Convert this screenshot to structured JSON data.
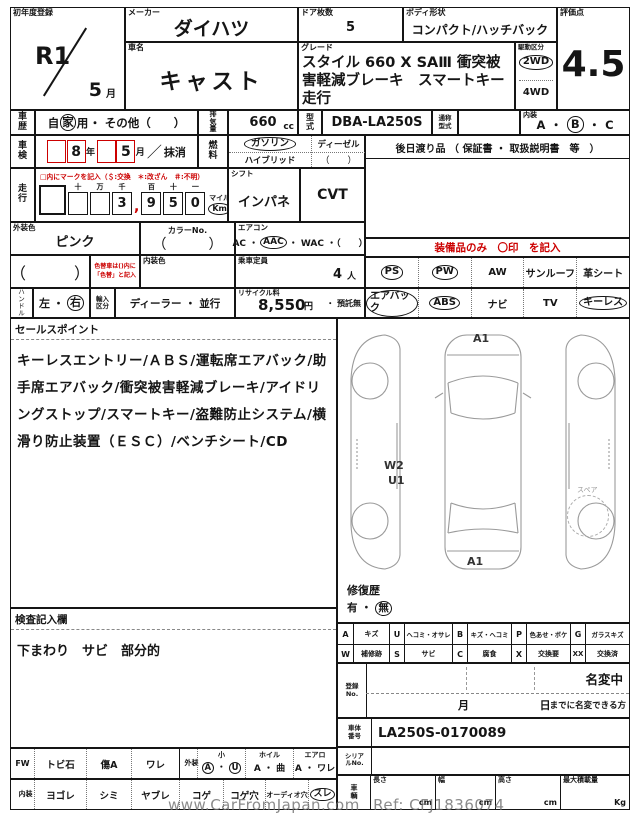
{
  "colors": {
    "line": "#151515",
    "red": "#cc0000",
    "watermark_gray": "#6e6e6e"
  },
  "watermark": {
    "site": "www.CarFromJapan.com",
    "ref": "Ref: CFJ1836074"
  },
  "header": {
    "first_reg_label": "初年度登録",
    "first_reg_year": "R1",
    "first_reg_month": "5",
    "month_suffix": "月",
    "maker_label": "メーカー",
    "maker": "ダイハツ",
    "car_name_label": "車名",
    "car_name": "キャスト",
    "doors_label": "ドア枚数",
    "doors": "5",
    "body_label": "ボディ形状",
    "body": "コンパクト/ハッチバック",
    "grade_label": "グレード",
    "grade": "スタイル 660 X SAⅢ 衝突被害軽減ブレーキ　スマートキー　走行",
    "drive_label": "駆動区分",
    "drive_2wd": "2WD",
    "drive_4wd": "4WD",
    "score_label": "評価点",
    "score": "4.5"
  },
  "history": {
    "label": "車歴",
    "use_pre": "自",
    "use_circled": "家",
    "use_post": "用",
    "use_other": "・ その他（　　）",
    "disp_label": "排気量",
    "disp_value": "660",
    "disp_unit": "cc",
    "model_label": "型式",
    "model_value": "DBA-LA250S",
    "alias_label": "通称型式",
    "interior_label": "内装",
    "interior_a": "A",
    "interior_b": "B",
    "interior_c": "C",
    "dot": "・"
  },
  "shaken": {
    "label": "車検",
    "year": "8",
    "year_suffix": "年",
    "month": "5",
    "month_suffix": "月",
    "slash": "／",
    "erased": "抹消",
    "fuel_label": "燃料",
    "fuel_gasoline": "ガソリン",
    "fuel_hybrid": "ハイブリッド",
    "fuel_diesel": "ディーゼル",
    "fuel_other": "（　　）",
    "later_items": "後日渡り品 （ 保証書 ・ 取扱説明書　等　）"
  },
  "mileage": {
    "label": "走行",
    "note": "□内にマークを記入（＄:交換　＊:改ざん　＃:不明）",
    "h1": "十",
    "h2": "万",
    "h3": "千",
    "h4": "百",
    "h5": "十",
    "h6": "一",
    "d1": "",
    "d2": "",
    "d3": "3",
    "comma": ",",
    "d4": "9",
    "d5": "5",
    "d6": "0",
    "unit_mile": "マイル",
    "unit_km": "Km",
    "shift_label": "シフト",
    "shift_value": "インパネ",
    "transmission": "CVT"
  },
  "colors_row": {
    "ext_label": "外装色",
    "ext_value": "ピンク",
    "colorno_label": "カラーNo.",
    "colorno_value": "（　　　）",
    "ac_label": "エアコン",
    "ac_pre": "AC ・",
    "ac_circled": "AAC",
    "ac_post": "・ WAC ・（　　）"
  },
  "repaint_row": {
    "parens": "（　　　）",
    "note1": "色替車は()内に",
    "note2": "「色替」と記入",
    "int_color_label": "内装色",
    "capacity_label": "乗車定員",
    "capacity_value": "4",
    "capacity_unit": "人"
  },
  "handle_row": {
    "label": "ハンドル",
    "left": "左",
    "dot": "・",
    "right": "右",
    "import_label": "輸入区分",
    "import_options": "ディーラー ・ 並行",
    "recycle_label": "リサイクル料",
    "recycle_value": "8,550",
    "recycle_unit": "円",
    "recycle_status": "・ 預託無"
  },
  "equipment": {
    "header": "装備品のみ　〇印　を記入",
    "row1": [
      {
        "label": "PS",
        "circled": true
      },
      {
        "label": "PW",
        "circled": true
      },
      {
        "label": "AW",
        "circled": false
      },
      {
        "label": "サンルーフ",
        "circled": false
      },
      {
        "label": "革シート",
        "circled": false
      }
    ],
    "row2": [
      {
        "label": "エアバック",
        "circled": true
      },
      {
        "label": "ABS",
        "circled": true
      },
      {
        "label": "ナビ",
        "circled": false
      },
      {
        "label": "TV",
        "circled": false
      },
      {
        "label": "キーレス",
        "circled": true
      }
    ]
  },
  "sales": {
    "header": "セールスポイント",
    "text": "キーレスエントリー/ＡＢＳ/運転席エアバック/助手席エアバック/衝突被害軽減ブレーキ/アイドリングストップ/スマートキー/盗難防止システム/横滑り防止装置（ＥＳＣ）/ベンチシート/CD"
  },
  "inspection": {
    "header": "検査記入欄",
    "text": "下まわり　サビ　部分的"
  },
  "diagram": {
    "front_label": "A1",
    "rear_label": "A1",
    "w2": "W2",
    "u1": "U1",
    "spare_label": "スペア"
  },
  "repair": {
    "label": "修復歴",
    "yes": "有",
    "dot": "・",
    "no": "無"
  },
  "legend": {
    "row1": [
      {
        "code": "A",
        "desc": "キズ"
      },
      {
        "code": "U",
        "desc": "ヘコミ・オサレ"
      },
      {
        "code": "B",
        "desc": "キズ・ヘコミ"
      },
      {
        "code": "P",
        "desc": "色あせ・ボケ"
      },
      {
        "code": "G",
        "desc": "ガラスキズ"
      }
    ],
    "row2": [
      {
        "code": "W",
        "desc": "補修跡"
      },
      {
        "code": "S",
        "desc": "サビ"
      },
      {
        "code": "C",
        "desc": "腐食"
      },
      {
        "code": "X",
        "desc": "交換要"
      },
      {
        "code": "XX",
        "desc": "交換済"
      }
    ]
  },
  "registration": {
    "label": "登録No.",
    "pending": "名変中",
    "month": "月",
    "day": "日",
    "note": "までに名変できる方"
  },
  "chassis": {
    "label": "車体番号",
    "value": "LA250S-0170089"
  },
  "serial": {
    "label": "シリアルNo."
  },
  "dims": {
    "label": "車輌",
    "length_label": "長さ",
    "length_unit": "cm",
    "width_label": "幅",
    "width_unit": "cm",
    "height_label": "高さ",
    "height_unit": "cm",
    "load_label": "最大積載量",
    "load_unit": "Kg"
  },
  "glass_row": {
    "label": "FW",
    "item1": "トビ石",
    "item2": "傷A",
    "item3": "ワレ",
    "ext_label": "外装",
    "small_header": "小",
    "small_a": "A",
    "small_dot": "・",
    "small_u": "U",
    "wheel_header": "ホイル",
    "wheel_options": "A ・ 曲",
    "aero_header": "エアロ",
    "aero_options": "A ・ ワレ"
  },
  "interior_row": {
    "label": "内装",
    "item1": "ヨゴレ",
    "item2": "シミ",
    "item3": "ヤブレ",
    "item4": "コゲ",
    "item5": "コゲ穴",
    "item6": "オーディオ穴",
    "item7": "スレ"
  }
}
